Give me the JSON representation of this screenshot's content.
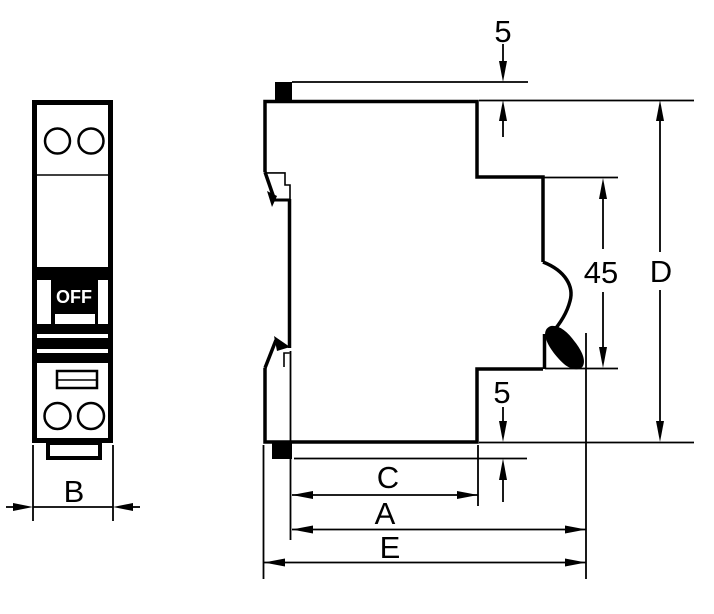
{
  "drawing_title": "Circuit breaker outline and mounting dimensions",
  "front_view": {
    "toggle_label": "OFF",
    "width_dim": "B"
  },
  "side_view": {
    "top_offset_dim": "5",
    "front_height_dim": "45",
    "overall_height_dim": "D",
    "bottom_offset_dim": "5",
    "front_depth_dim": "C",
    "body_depth_dim": "A",
    "overall_depth_dim": "E"
  },
  "colors": {
    "line": "#000000",
    "background": "#ffffff",
    "toggle_background": "#000000",
    "toggle_text": "#ffffff"
  }
}
